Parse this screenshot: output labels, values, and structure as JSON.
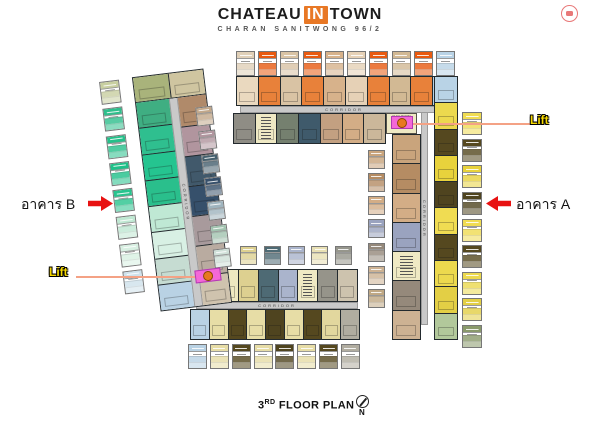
{
  "header": {
    "title_part1": "CHATEAU",
    "title_in": "IN",
    "title_part2": "TOWN",
    "subtitle": "CHARAN SANITWONG 96/2"
  },
  "labels": {
    "building_b": "อาคาร B",
    "building_a": "อาคาร A",
    "lift": "Lift",
    "corridor": "CORRIDOR",
    "elec_room": "ELEC ROOM",
    "floor_num": "3",
    "floor_sup": "RD",
    "floor_rest": " FLOOR PLAN",
    "north": "N"
  },
  "colors": {
    "accent_orange": "#e87825",
    "arrow_red": "#e81212",
    "lift_pink": "#f468d8",
    "lift_circle": "#e87820",
    "leader_line": "#f4a285",
    "lift_label_yellow": "#f5d800",
    "badge_red": "#e87878"
  },
  "plan": {
    "top_wing": {
      "outer_units": [
        "#ead9bf",
        "#e8813a",
        "#d9c3a4",
        "#e8813a",
        "#d7b28b",
        "#e6d1b6",
        "#e8813a",
        "#d2b994",
        "#e8813a",
        "#b9d3e6"
      ],
      "inner_units": [
        "#8f8d85",
        {
          "color": "#efe9c4",
          "stripes": true
        },
        "#75806f",
        "#3f5a6b",
        "#c3a081",
        "#d3ad86",
        "#cbb79a"
      ]
    },
    "right_wing": {
      "outer_units": [
        "#b9d3e6",
        "#ecd94e",
        "#55481f",
        "#e8d23c",
        "#4f441f",
        "#f0dc52",
        "#55481f",
        "#ecd94e",
        "#e3cf45",
        "#b2c89b"
      ],
      "inner_units": [
        "#c9a47c",
        "#b58c63",
        "#d3ad86",
        "#9aa3bf",
        {
          "color": "#efe9c4",
          "stripes": true
        },
        "#95897b",
        "#cdb293"
      ]
    },
    "bottom_wing": {
      "inner_units": [
        "#eee8c0",
        "#ddd090",
        "#4e6a74",
        "#aab4cc",
        {
          "color": "#efe9c4",
          "stripes": true
        },
        "#96948a",
        "#cdc3ae"
      ],
      "outer_units": [
        "#b9d2e4",
        "#e7dda6",
        "#55481f",
        "#e7dda6",
        "#4f441f",
        "#e7dda6",
        "#55481f",
        "#e2d79e",
        "#b1ada0"
      ]
    },
    "left_wing": {
      "top_units": [
        "#a9b37b",
        "#cfc5a0"
      ],
      "outer_units": [
        "#3fae82",
        "#2fbf8f",
        "#25c490",
        "#2abf8c",
        "#bfe8d4",
        "#d8f0e4",
        "#c6dcd2",
        "#b9d2e4"
      ],
      "inner_units": [
        "#b08a6a",
        "#b1959e",
        "#41596b",
        "#36506b",
        "#a89a9c",
        "#b9aba0",
        "#cfc3ae"
      ]
    },
    "tags": {
      "top": [
        "#e0d0b8",
        "#e85a10",
        "#d9c3a4",
        "#e85a10",
        "#d7b28b",
        "#e6d1b6",
        "#e85a10",
        "#d2b994",
        "#e85a10",
        "#b9d3e6"
      ],
      "right_outer": [
        "#f0dc52",
        "#55481f",
        "#e8d23c",
        "#4f441f",
        "#f0dc52",
        "#55481f",
        "#ecd94e",
        "#e3cf45",
        "#8a9a6b"
      ],
      "right_inner": [
        "#c9a47c",
        "#b58c63",
        "#d3ad86",
        "#9aa3bf",
        "#95897b",
        "#cdb293",
        "#c0a884"
      ],
      "bottom_outer": [
        "#b9d2e4",
        "#e7dda6",
        "#55481f",
        "#e7dda6",
        "#4f441f",
        "#e7dda6",
        "#55481f",
        "#b1ada0"
      ],
      "bottom_inner": [
        "#ddd090",
        "#4e6a74",
        "#aab4cc",
        "#e8e0b4",
        "#96968c"
      ],
      "left_outer": [
        "#c8cfa0",
        "#2fbf8c",
        "#25c08a",
        "#1fc089",
        "#28c48e",
        "#bfe8d2",
        "#d8f0e2",
        "#cfe2ec"
      ],
      "left_inner": [
        "#c3a88a",
        "#b1959e",
        "#45606e",
        "#37506b",
        "#9fb4be",
        "#a2c4b0",
        "#cfe0d8"
      ]
    }
  }
}
